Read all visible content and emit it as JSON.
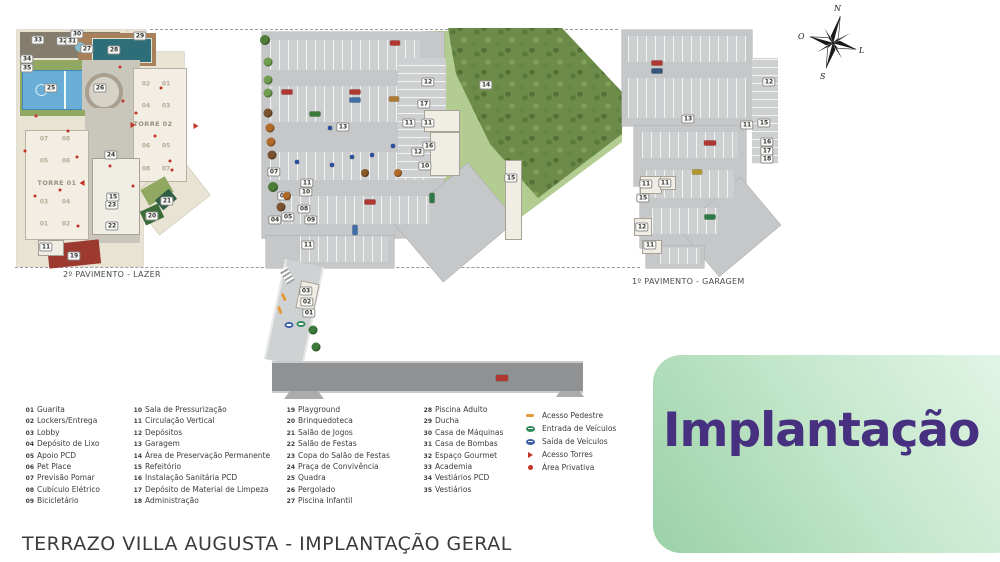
{
  "page": {
    "footer_title": "TERRAZO VILLA AUGUSTA - IMPLANTAÇÃO GERAL"
  },
  "title_box": {
    "label": "Implantação",
    "text_color": "#46307f",
    "bg_from": "#9bd1a7",
    "bg_to": "#e4f6e9"
  },
  "plans": {
    "lazer": {
      "caption": "2º PAVIMENTO - LAZER"
    },
    "garagem": {
      "caption": "1º PAVIMENTO - GARAGEM"
    }
  },
  "compass": {
    "north": "N",
    "west": "O",
    "east": "L",
    "south": "S"
  },
  "legend": {
    "columns": [
      [
        {
          "n": "01",
          "label": "Guarita"
        },
        {
          "n": "02",
          "label": "Lockers/Entrega"
        },
        {
          "n": "03",
          "label": "Lobby"
        },
        {
          "n": "04",
          "label": "Depósito de Lixo"
        },
        {
          "n": "05",
          "label": "Apoio PCD"
        },
        {
          "n": "06",
          "label": "Pet Place"
        },
        {
          "n": "07",
          "label": "Previsão Pomar"
        },
        {
          "n": "08",
          "label": "Cubículo Elétrico"
        },
        {
          "n": "09",
          "label": "Bicicletário"
        }
      ],
      [
        {
          "n": "10",
          "label": "Sala de Pressurização"
        },
        {
          "n": "11",
          "label": "Circulação Vertical"
        },
        {
          "n": "12",
          "label": "Depósitos"
        },
        {
          "n": "13",
          "label": "Garagem"
        },
        {
          "n": "14",
          "label": "Área de Preservação Permanente"
        },
        {
          "n": "15",
          "label": "Refeitório"
        },
        {
          "n": "16",
          "label": "Instalação Sanitária PCD"
        },
        {
          "n": "17",
          "label": "Depósito de Material de Limpeza"
        },
        {
          "n": "18",
          "label": "Administração"
        }
      ],
      [
        {
          "n": "19",
          "label": "Playground"
        },
        {
          "n": "20",
          "label": "Brinquedoteca"
        },
        {
          "n": "21",
          "label": "Salão de Jogos"
        },
        {
          "n": "22",
          "label": "Salão de Festas"
        },
        {
          "n": "23",
          "label": "Copa do Salão de Festas"
        },
        {
          "n": "24",
          "label": "Praça de Convivência"
        },
        {
          "n": "25",
          "label": "Quadra"
        },
        {
          "n": "26",
          "label": "Pergolado"
        },
        {
          "n": "27",
          "label": "Piscina Infantil"
        }
      ],
      [
        {
          "n": "28",
          "label": "Piscina Adulto"
        },
        {
          "n": "29",
          "label": "Ducha"
        },
        {
          "n": "30",
          "label": "Casa de Máquinas"
        },
        {
          "n": "31",
          "label": "Casa de Bombas"
        },
        {
          "n": "32",
          "label": "Espaço Gourmet"
        },
        {
          "n": "33",
          "label": "Academia"
        },
        {
          "n": "34",
          "label": "Vestiários PCD"
        },
        {
          "n": "35",
          "label": "Vestiários"
        }
      ]
    ],
    "symbols": [
      {
        "type": "dash",
        "color": "#e39b3a",
        "label": "Acesso Pedestre"
      },
      {
        "type": "oval",
        "color": "#2f8a57",
        "label": "Entrada de Veículos"
      },
      {
        "type": "oval",
        "color": "#3b5ea9",
        "label": "Saída de Veículos"
      },
      {
        "type": "triangle",
        "color": "#c23327",
        "label": "Acesso Torres"
      },
      {
        "type": "circle",
        "color": "#c23327",
        "label": "Área Privativa"
      }
    ]
  },
  "plan_annotations": {
    "badges": [
      {
        "n": "33",
        "x": 38,
        "y": 40
      },
      {
        "n": "32",
        "x": 63,
        "y": 41
      },
      {
        "n": "31",
        "x": 72,
        "y": 41
      },
      {
        "n": "30",
        "x": 77,
        "y": 34
      },
      {
        "n": "27",
        "x": 87,
        "y": 49
      },
      {
        "n": "28",
        "x": 114,
        "y": 50
      },
      {
        "n": "29",
        "x": 140,
        "y": 36
      },
      {
        "n": "34",
        "x": 27,
        "y": 59
      },
      {
        "n": "35",
        "x": 27,
        "y": 68
      },
      {
        "n": "25",
        "x": 51,
        "y": 88
      },
      {
        "n": "26",
        "x": 100,
        "y": 88
      },
      {
        "n": "24",
        "x": 111,
        "y": 155
      },
      {
        "n": "15",
        "x": 113,
        "y": 197
      },
      {
        "n": "23",
        "x": 112,
        "y": 205
      },
      {
        "n": "22",
        "x": 112,
        "y": 226
      },
      {
        "n": "20",
        "x": 152,
        "y": 216
      },
      {
        "n": "21",
        "x": 167,
        "y": 201
      },
      {
        "n": "19",
        "x": 74,
        "y": 256
      },
      {
        "n": "11",
        "x": 46,
        "y": 247
      },
      {
        "n": "13",
        "x": 343,
        "y": 127
      },
      {
        "n": "14",
        "x": 486,
        "y": 85
      },
      {
        "n": "12",
        "x": 428,
        "y": 82
      },
      {
        "n": "17",
        "x": 424,
        "y": 104
      },
      {
        "n": "11",
        "x": 409,
        "y": 123
      },
      {
        "n": "11",
        "x": 428,
        "y": 123
      },
      {
        "n": "16",
        "x": 429,
        "y": 146
      },
      {
        "n": "12",
        "x": 418,
        "y": 152
      },
      {
        "n": "10",
        "x": 425,
        "y": 166
      },
      {
        "n": "15",
        "x": 511,
        "y": 178
      },
      {
        "n": "07",
        "x": 274,
        "y": 172
      },
      {
        "n": "06",
        "x": 284,
        "y": 196
      },
      {
        "n": "05",
        "x": 288,
        "y": 217
      },
      {
        "n": "04",
        "x": 275,
        "y": 220
      },
      {
        "n": "08",
        "x": 304,
        "y": 209
      },
      {
        "n": "09",
        "x": 311,
        "y": 220
      },
      {
        "n": "10",
        "x": 306,
        "y": 192
      },
      {
        "n": "11",
        "x": 307,
        "y": 183
      },
      {
        "n": "11",
        "x": 308,
        "y": 245
      },
      {
        "n": "03",
        "x": 306,
        "y": 291
      },
      {
        "n": "02",
        "x": 307,
        "y": 302
      },
      {
        "n": "01",
        "x": 309,
        "y": 313
      },
      {
        "n": "13",
        "x": 688,
        "y": 119
      },
      {
        "n": "12",
        "x": 769,
        "y": 82
      },
      {
        "n": "15",
        "x": 764,
        "y": 123
      },
      {
        "n": "11",
        "x": 747,
        "y": 125
      },
      {
        "n": "16",
        "x": 767,
        "y": 142
      },
      {
        "n": "17",
        "x": 767,
        "y": 151
      },
      {
        "n": "18",
        "x": 767,
        "y": 159
      },
      {
        "n": "11",
        "x": 646,
        "y": 184
      },
      {
        "n": "11",
        "x": 665,
        "y": 183
      },
      {
        "n": "15",
        "x": 643,
        "y": 198
      },
      {
        "n": "12",
        "x": 642,
        "y": 227
      },
      {
        "n": "11",
        "x": 650,
        "y": 245
      }
    ],
    "units": [
      {
        "n": "02",
        "x": 146,
        "y": 84
      },
      {
        "n": "01",
        "x": 166,
        "y": 84
      },
      {
        "n": "04",
        "x": 146,
        "y": 106
      },
      {
        "n": "03",
        "x": 166,
        "y": 106
      },
      {
        "n": "06",
        "x": 146,
        "y": 146
      },
      {
        "n": "05",
        "x": 166,
        "y": 146
      },
      {
        "n": "08",
        "x": 146,
        "y": 169
      },
      {
        "n": "07",
        "x": 166,
        "y": 169
      },
      {
        "n": "07",
        "x": 44,
        "y": 139
      },
      {
        "n": "08",
        "x": 66,
        "y": 139
      },
      {
        "n": "05",
        "x": 44,
        "y": 161
      },
      {
        "n": "06",
        "x": 66,
        "y": 161
      },
      {
        "n": "03",
        "x": 44,
        "y": 202
      },
      {
        "n": "04",
        "x": 66,
        "y": 202
      },
      {
        "n": "01",
        "x": 44,
        "y": 224
      },
      {
        "n": "02",
        "x": 66,
        "y": 224
      }
    ],
    "towers": [
      {
        "label": "TORRE 01",
        "x": 57,
        "y": 183
      },
      {
        "label": "TORRE 02",
        "x": 153,
        "y": 124
      }
    ],
    "private_dots": [
      {
        "x": 36,
        "y": 116
      },
      {
        "x": 25,
        "y": 151
      },
      {
        "x": 68,
        "y": 131
      },
      {
        "x": 35,
        "y": 196
      },
      {
        "x": 60,
        "y": 190
      },
      {
        "x": 78,
        "y": 226
      },
      {
        "x": 110,
        "y": 166
      },
      {
        "x": 123,
        "y": 101
      },
      {
        "x": 136,
        "y": 113
      },
      {
        "x": 155,
        "y": 136
      },
      {
        "x": 170,
        "y": 161
      },
      {
        "x": 133,
        "y": 186
      },
      {
        "x": 120,
        "y": 67
      },
      {
        "x": 161,
        "y": 88
      },
      {
        "x": 172,
        "y": 170
      },
      {
        "x": 77,
        "y": 157
      }
    ],
    "tower_arrows": [
      {
        "x": 82,
        "y": 183,
        "r": 180
      },
      {
        "x": 133,
        "y": 125,
        "r": 0
      },
      {
        "x": 196,
        "y": 126,
        "r": 0
      }
    ],
    "vehicle_access_icons": [
      {
        "x": 289,
        "y": 325,
        "color": "#3b5ea9"
      },
      {
        "x": 301,
        "y": 324,
        "color": "#2f8a57"
      }
    ],
    "pedestrian_dashes": [
      {
        "x": 284,
        "y": 297,
        "r": 65
      },
      {
        "x": 280,
        "y": 310,
        "r": 70
      }
    ],
    "cars": [
      {
        "x": 395,
        "y": 43,
        "w": 10,
        "h": 5,
        "color": "#b03830"
      },
      {
        "x": 287,
        "y": 92,
        "w": 11,
        "h": 5,
        "color": "#b03830"
      },
      {
        "x": 355,
        "y": 92,
        "w": 11,
        "h": 5,
        "color": "#b03830"
      },
      {
        "x": 355,
        "y": 100,
        "w": 11,
        "h": 5,
        "color": "#3f6fa8"
      },
      {
        "x": 315,
        "y": 114,
        "w": 11,
        "h": 5,
        "color": "#3e7a3c"
      },
      {
        "x": 394,
        "y": 99,
        "w": 10,
        "h": 5,
        "color": "#b07830"
      },
      {
        "x": 370,
        "y": 202,
        "w": 11,
        "h": 5,
        "color": "#b03830"
      },
      {
        "x": 355,
        "y": 230,
        "w": 5,
        "h": 10,
        "color": "#3f6fa8"
      },
      {
        "x": 432,
        "y": 198,
        "w": 5,
        "h": 10,
        "color": "#2e7a45"
      },
      {
        "x": 502,
        "y": 378,
        "w": 12,
        "h": 6,
        "color": "#b03830"
      },
      {
        "x": 297,
        "y": 162,
        "w": 4,
        "h": 4,
        "color": "#2a4f9e"
      },
      {
        "x": 332,
        "y": 165,
        "w": 4,
        "h": 4,
        "color": "#2a4f9e"
      },
      {
        "x": 352,
        "y": 157,
        "w": 4,
        "h": 4,
        "color": "#2a4f9e"
      },
      {
        "x": 372,
        "y": 155,
        "w": 4,
        "h": 4,
        "color": "#2a4f9e"
      },
      {
        "x": 393,
        "y": 146,
        "w": 4,
        "h": 4,
        "color": "#2a4f9e"
      },
      {
        "x": 330,
        "y": 128,
        "w": 4,
        "h": 4,
        "color": "#2a4f9e"
      },
      {
        "x": 657,
        "y": 63,
        "w": 11,
        "h": 5,
        "color": "#b03830"
      },
      {
        "x": 657,
        "y": 71,
        "w": 11,
        "h": 5,
        "color": "#33567d"
      },
      {
        "x": 710,
        "y": 143,
        "w": 12,
        "h": 5,
        "color": "#b03830"
      },
      {
        "x": 697,
        "y": 172,
        "w": 10,
        "h": 5,
        "color": "#b0982e"
      },
      {
        "x": 710,
        "y": 217,
        "w": 11,
        "h": 5,
        "color": "#2e7a45"
      }
    ],
    "trees": [
      {
        "x": 265,
        "y": 40,
        "d": 10,
        "color": "#4e7d3a"
      },
      {
        "x": 268,
        "y": 62,
        "d": 9,
        "color": "#6f9e4f"
      },
      {
        "x": 268,
        "y": 80,
        "d": 9,
        "color": "#6f9e4f"
      },
      {
        "x": 268,
        "y": 93,
        "d": 9,
        "color": "#6f9e4f"
      },
      {
        "x": 268,
        "y": 113,
        "d": 9,
        "color": "#7a5230"
      },
      {
        "x": 270,
        "y": 128,
        "d": 9,
        "color": "#b06a2a"
      },
      {
        "x": 271,
        "y": 142,
        "d": 9,
        "color": "#b06a2a"
      },
      {
        "x": 272,
        "y": 155,
        "d": 9,
        "color": "#7a5230"
      },
      {
        "x": 273,
        "y": 187,
        "d": 10,
        "color": "#4e7d3a"
      },
      {
        "x": 281,
        "y": 207,
        "d": 9,
        "color": "#7a5230"
      },
      {
        "x": 287,
        "y": 196,
        "d": 8,
        "color": "#b06a2a"
      },
      {
        "x": 313,
        "y": 330,
        "d": 9,
        "color": "#3e7a3c"
      },
      {
        "x": 316,
        "y": 347,
        "d": 9,
        "color": "#3e7a3c"
      },
      {
        "x": 365,
        "y": 173,
        "d": 8,
        "color": "#8a5a28"
      },
      {
        "x": 398,
        "y": 173,
        "d": 8,
        "color": "#b06a2a"
      }
    ]
  }
}
